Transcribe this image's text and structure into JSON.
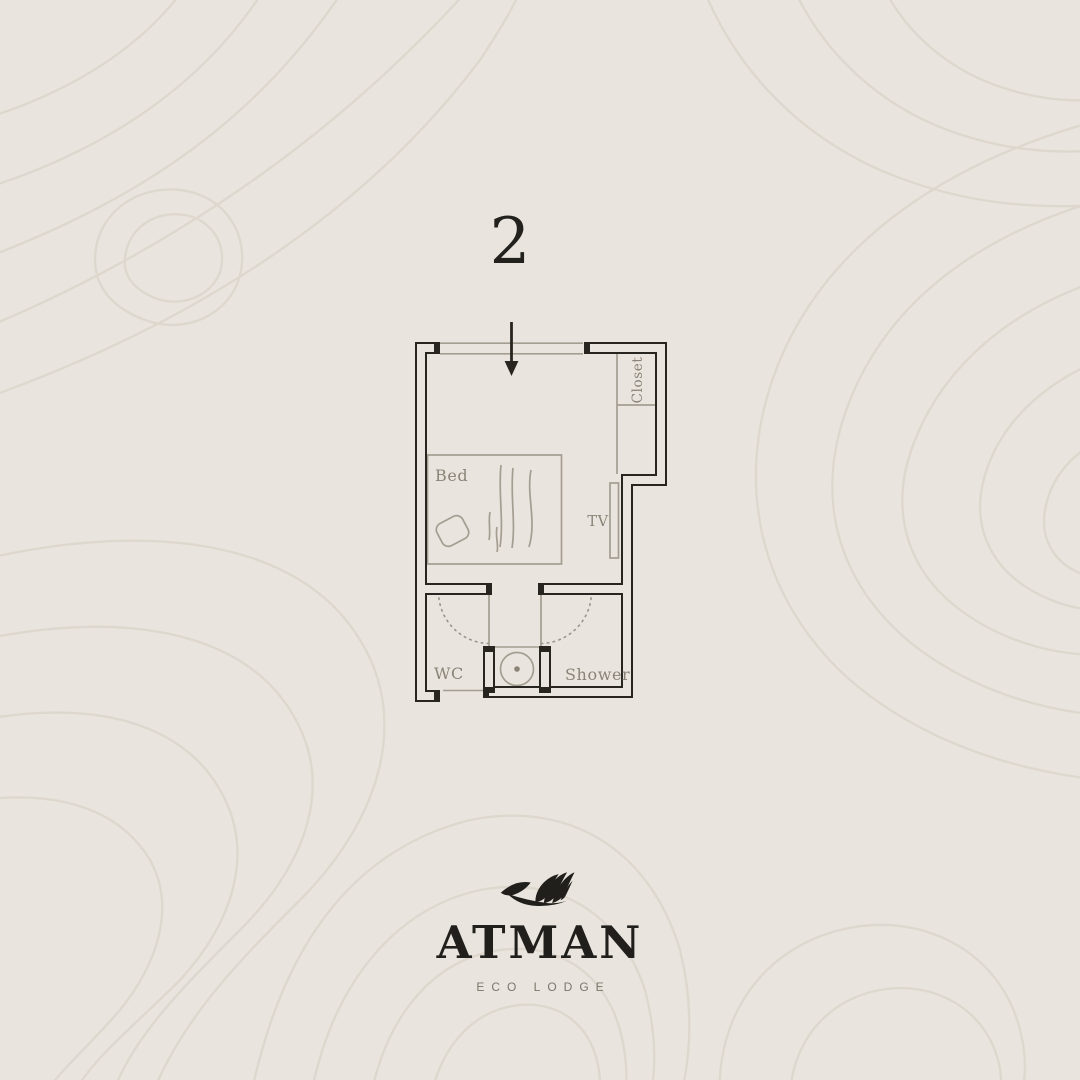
{
  "page": {
    "bg_color": "#e9e4dd",
    "contour_color": "#d8d0c5"
  },
  "plan": {
    "room_number": "2",
    "entrance_icon": "entrance-arrow-icon",
    "labels": {
      "bed": "Bed",
      "tv": "TV",
      "closet": "Closet",
      "wc": "WC",
      "shower": "Shower"
    },
    "colors": {
      "wall": "#282521",
      "furniture": "#a49d91",
      "swing": "#9a948a",
      "label": "#8a8377"
    }
  },
  "brand": {
    "icon": "leaf-icon",
    "name": "ATMAN",
    "tagline": "ECO LODGE",
    "name_color": "#211f1b",
    "tagline_color": "#7c766b"
  }
}
